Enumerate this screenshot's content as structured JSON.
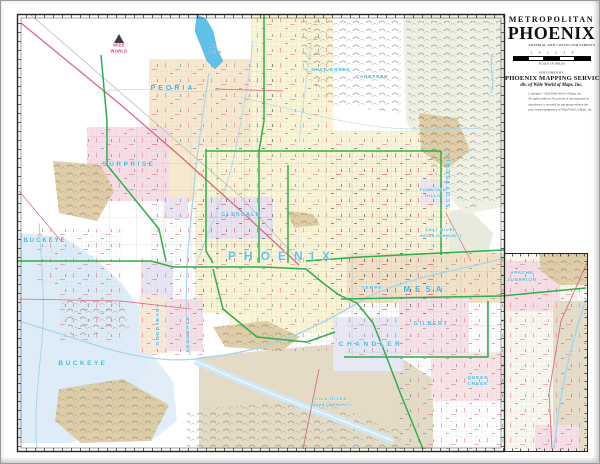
{
  "title_block": {
    "kicker": "METROPOLITAN",
    "title": "PHOENIX",
    "subtitle": "ARTERIAL AND COLLECTOR STREETS",
    "scale_numbers": [
      "1",
      "0",
      "1",
      "2",
      "3",
      "4"
    ],
    "scale_label": "SCALE IN MILES",
    "published_by": "PUBLISHED BY",
    "publisher": "PHOENIX MAPPING SERVICE",
    "publisher_division": "div. of Wide World of Maps, Inc.",
    "copyright_lines": [
      "Copyright © 2020 Wide World of Maps, Inc.",
      "All rights reserved. No portion of this map may be",
      "reproduced or recorded by any means without the",
      "prior written permission of Wide World of Maps, Inc."
    ]
  },
  "logo": {
    "name": "Wide World of Maps",
    "line1": "WIDE",
    "line2": "WORLD"
  },
  "map": {
    "colors": {
      "city_label": "#3bb3da",
      "freeway_green": "#2fae4a",
      "highway_red": "#d96a7c",
      "water_blue": "#5fc0e8",
      "urban_yellow": "#faf5d5",
      "mountain_tan": "#dcc9a0"
    },
    "labels": [
      {
        "t": "PEORIA",
        "x": 172,
        "y": 89,
        "s": 7,
        "sp": 3,
        "k": "c"
      },
      {
        "t": "SURPRISE",
        "x": 128,
        "y": 165,
        "s": 6.5,
        "sp": 2.5,
        "k": "c"
      },
      {
        "t": "BUCKEYE",
        "x": 44,
        "y": 241,
        "s": 6,
        "sp": 2,
        "k": "c"
      },
      {
        "t": "BUCKEYE",
        "x": 82,
        "y": 364,
        "s": 6.5,
        "sp": 2.5,
        "k": "c"
      },
      {
        "t": "PHOENIX",
        "x": 282,
        "y": 259,
        "s": 12,
        "sp": 8,
        "k": "b"
      },
      {
        "t": "GLENDALE",
        "x": 240,
        "y": 215,
        "s": 5,
        "sp": 1.5,
        "k": "c"
      },
      {
        "t": "SCOTTSDALE",
        "x": 449,
        "y": 178,
        "s": 5.5,
        "sp": 2,
        "r": -90,
        "k": "c"
      },
      {
        "t": "MESA",
        "x": 424,
        "y": 291,
        "s": 8,
        "sp": 5,
        "k": "c"
      },
      {
        "t": "TEMPE",
        "x": 371,
        "y": 288,
        "s": 4.5,
        "sp": 1,
        "k": "c"
      },
      {
        "t": "CHANDLER",
        "x": 370,
        "y": 345,
        "s": 6.5,
        "sp": 3.5,
        "k": "c"
      },
      {
        "t": "GILBERT",
        "x": 430,
        "y": 324,
        "s": 5.5,
        "sp": 1.5,
        "k": "c"
      },
      {
        "t": "QUEEN",
        "x": 477,
        "y": 378,
        "s": 4.5,
        "sp": 1,
        "k": "c"
      },
      {
        "t": "CREEK",
        "x": 477,
        "y": 384,
        "s": 4.5,
        "sp": 1,
        "k": "c"
      },
      {
        "t": "APACHE",
        "x": 521,
        "y": 273,
        "s": 4.5,
        "sp": 0.8,
        "k": "c"
      },
      {
        "t": "JUNCTION",
        "x": 521,
        "y": 280,
        "s": 4.5,
        "sp": 0.8,
        "k": "c"
      },
      {
        "t": "GOODYEAR",
        "x": 158,
        "y": 325,
        "s": 4.5,
        "sp": 1.5,
        "r": -90,
        "k": "c"
      },
      {
        "t": "AVONDALE",
        "x": 188,
        "y": 333,
        "s": 4.5,
        "sp": 1.5,
        "r": -90,
        "k": "c"
      },
      {
        "t": "CAVE CREEK",
        "x": 330,
        "y": 70,
        "s": 4.5,
        "sp": 1,
        "k": "c"
      },
      {
        "t": "CAREFREE",
        "x": 371,
        "y": 77,
        "s": 4.5,
        "sp": 1,
        "k": "c"
      },
      {
        "t": "FOUNTAIN",
        "x": 432,
        "y": 190,
        "s": 4,
        "sp": 0.8,
        "k": "c"
      },
      {
        "t": "HILLS",
        "x": 432,
        "y": 196,
        "s": 4,
        "sp": 0.8,
        "k": "c"
      },
      {
        "t": "SALT RIVER",
        "x": 440,
        "y": 230,
        "s": 4,
        "sp": 0.8,
        "k": "c"
      },
      {
        "t": "INDIAN COMMUNITY",
        "x": 440,
        "y": 236,
        "s": 3.5,
        "sp": 0.5,
        "k": "c"
      },
      {
        "t": "GILA RIVER",
        "x": 330,
        "y": 399,
        "s": 4,
        "sp": 1,
        "k": "c"
      },
      {
        "t": "INDIAN COMMUNITY",
        "x": 330,
        "y": 405,
        "s": 3.5,
        "sp": 0.5,
        "k": "c"
      },
      {
        "t": "Lake",
        "x": 212,
        "y": 46,
        "s": 4,
        "sp": 0,
        "k": "w"
      },
      {
        "t": "Pleasant",
        "x": 213,
        "y": 52,
        "s": 4,
        "sp": 0,
        "k": "w"
      }
    ]
  }
}
